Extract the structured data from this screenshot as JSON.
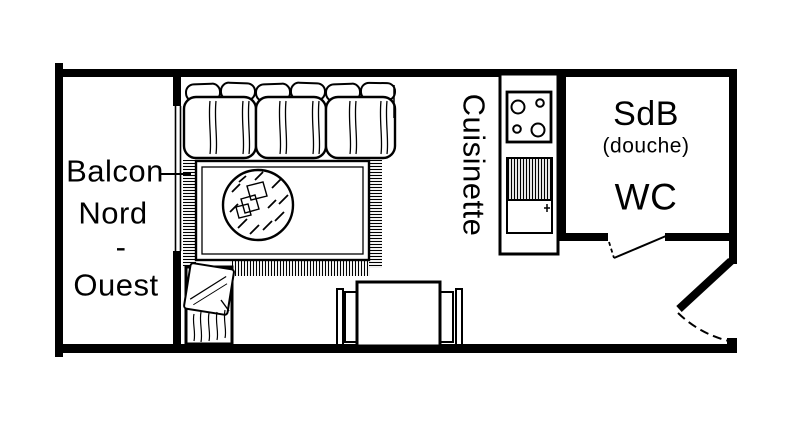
{
  "colors": {
    "ink": "#000000",
    "background": "#ffffff"
  },
  "rooms": {
    "balcony": {
      "lines": [
        "Balcon",
        "Nord",
        "-",
        "Ouest"
      ]
    },
    "kitchenette": {
      "label": "Cuisinette"
    },
    "bathroom": {
      "name": "SdB",
      "detail": "(douche)",
      "wc": "WC"
    }
  }
}
